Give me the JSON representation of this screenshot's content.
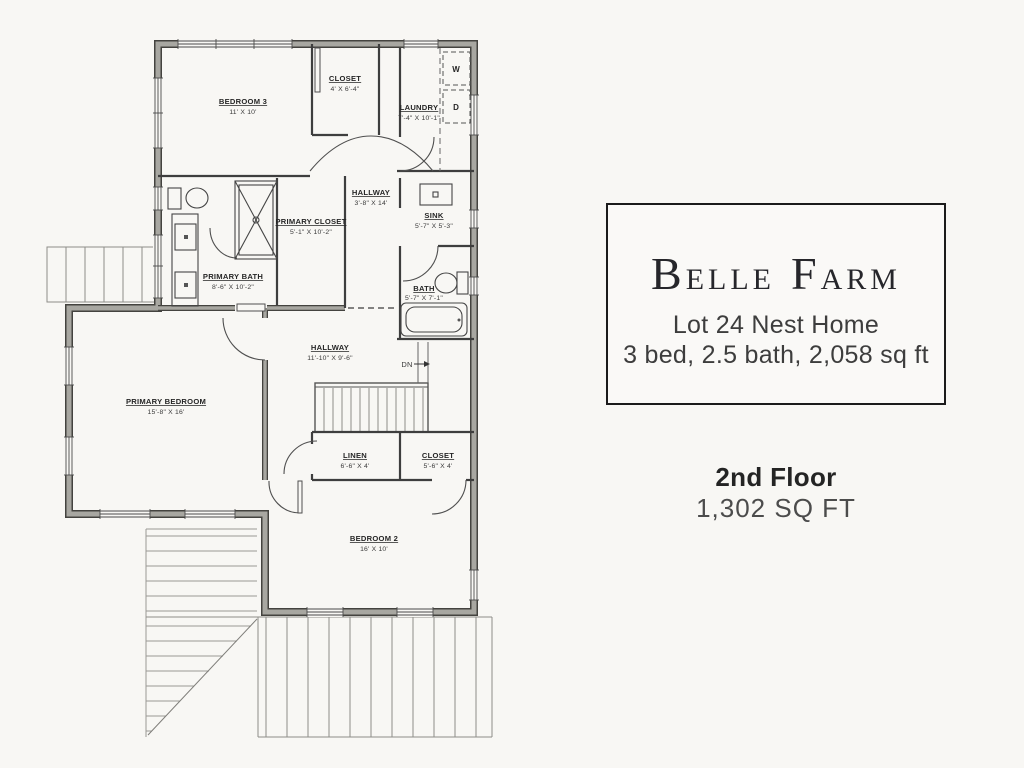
{
  "page": {
    "background": "#f8f7f4"
  },
  "floorplan": {
    "rooms": [
      {
        "name": "BEDROOM 3",
        "dims": "11' X 10'"
      },
      {
        "name": "CLOSET",
        "dims": "4' X 6'-4\""
      },
      {
        "name": "LAUNDRY",
        "dims": "7'-4\" X 10'-1\""
      },
      {
        "name": "HALLWAY",
        "dims": "3'-8\" X 14'"
      },
      {
        "name": "PRIMARY CLOSET",
        "dims": "5'-1\" X 10'-2\""
      },
      {
        "name": "SINK",
        "dims": "5'-7\" X 5'-3\""
      },
      {
        "name": "PRIMARY BATH",
        "dims": "8'-6\" X 10'-2\""
      },
      {
        "name": "BATH",
        "dims": "5'-7\" X 7'-1\""
      },
      {
        "name": "HALLWAY",
        "dims": "11'-10\" X 9'-6\""
      },
      {
        "name": "PRIMARY BEDROOM",
        "dims": "15'-8\" X 16'"
      },
      {
        "name": "LINEN",
        "dims": "6'-6\" X 4'"
      },
      {
        "name": "CLOSET",
        "dims": "5'-6\" X 4'"
      },
      {
        "name": "BEDROOM 2",
        "dims": "16' X 10'"
      }
    ],
    "markers": {
      "washer": "W",
      "dryer": "D",
      "stairs_down": "DN"
    }
  },
  "title_block": {
    "brand": {
      "word1_initial": "B",
      "word1_rest": "ELLE",
      "word2_initial": "F",
      "word2_rest": "ARM"
    },
    "lot_line": "Lot 24 Nest Home",
    "specs_line": "3 bed, 2.5 bath, 2,058 sq ft"
  },
  "floor_label": {
    "floor": "2nd Floor",
    "area": "1,302 SQ FT"
  }
}
